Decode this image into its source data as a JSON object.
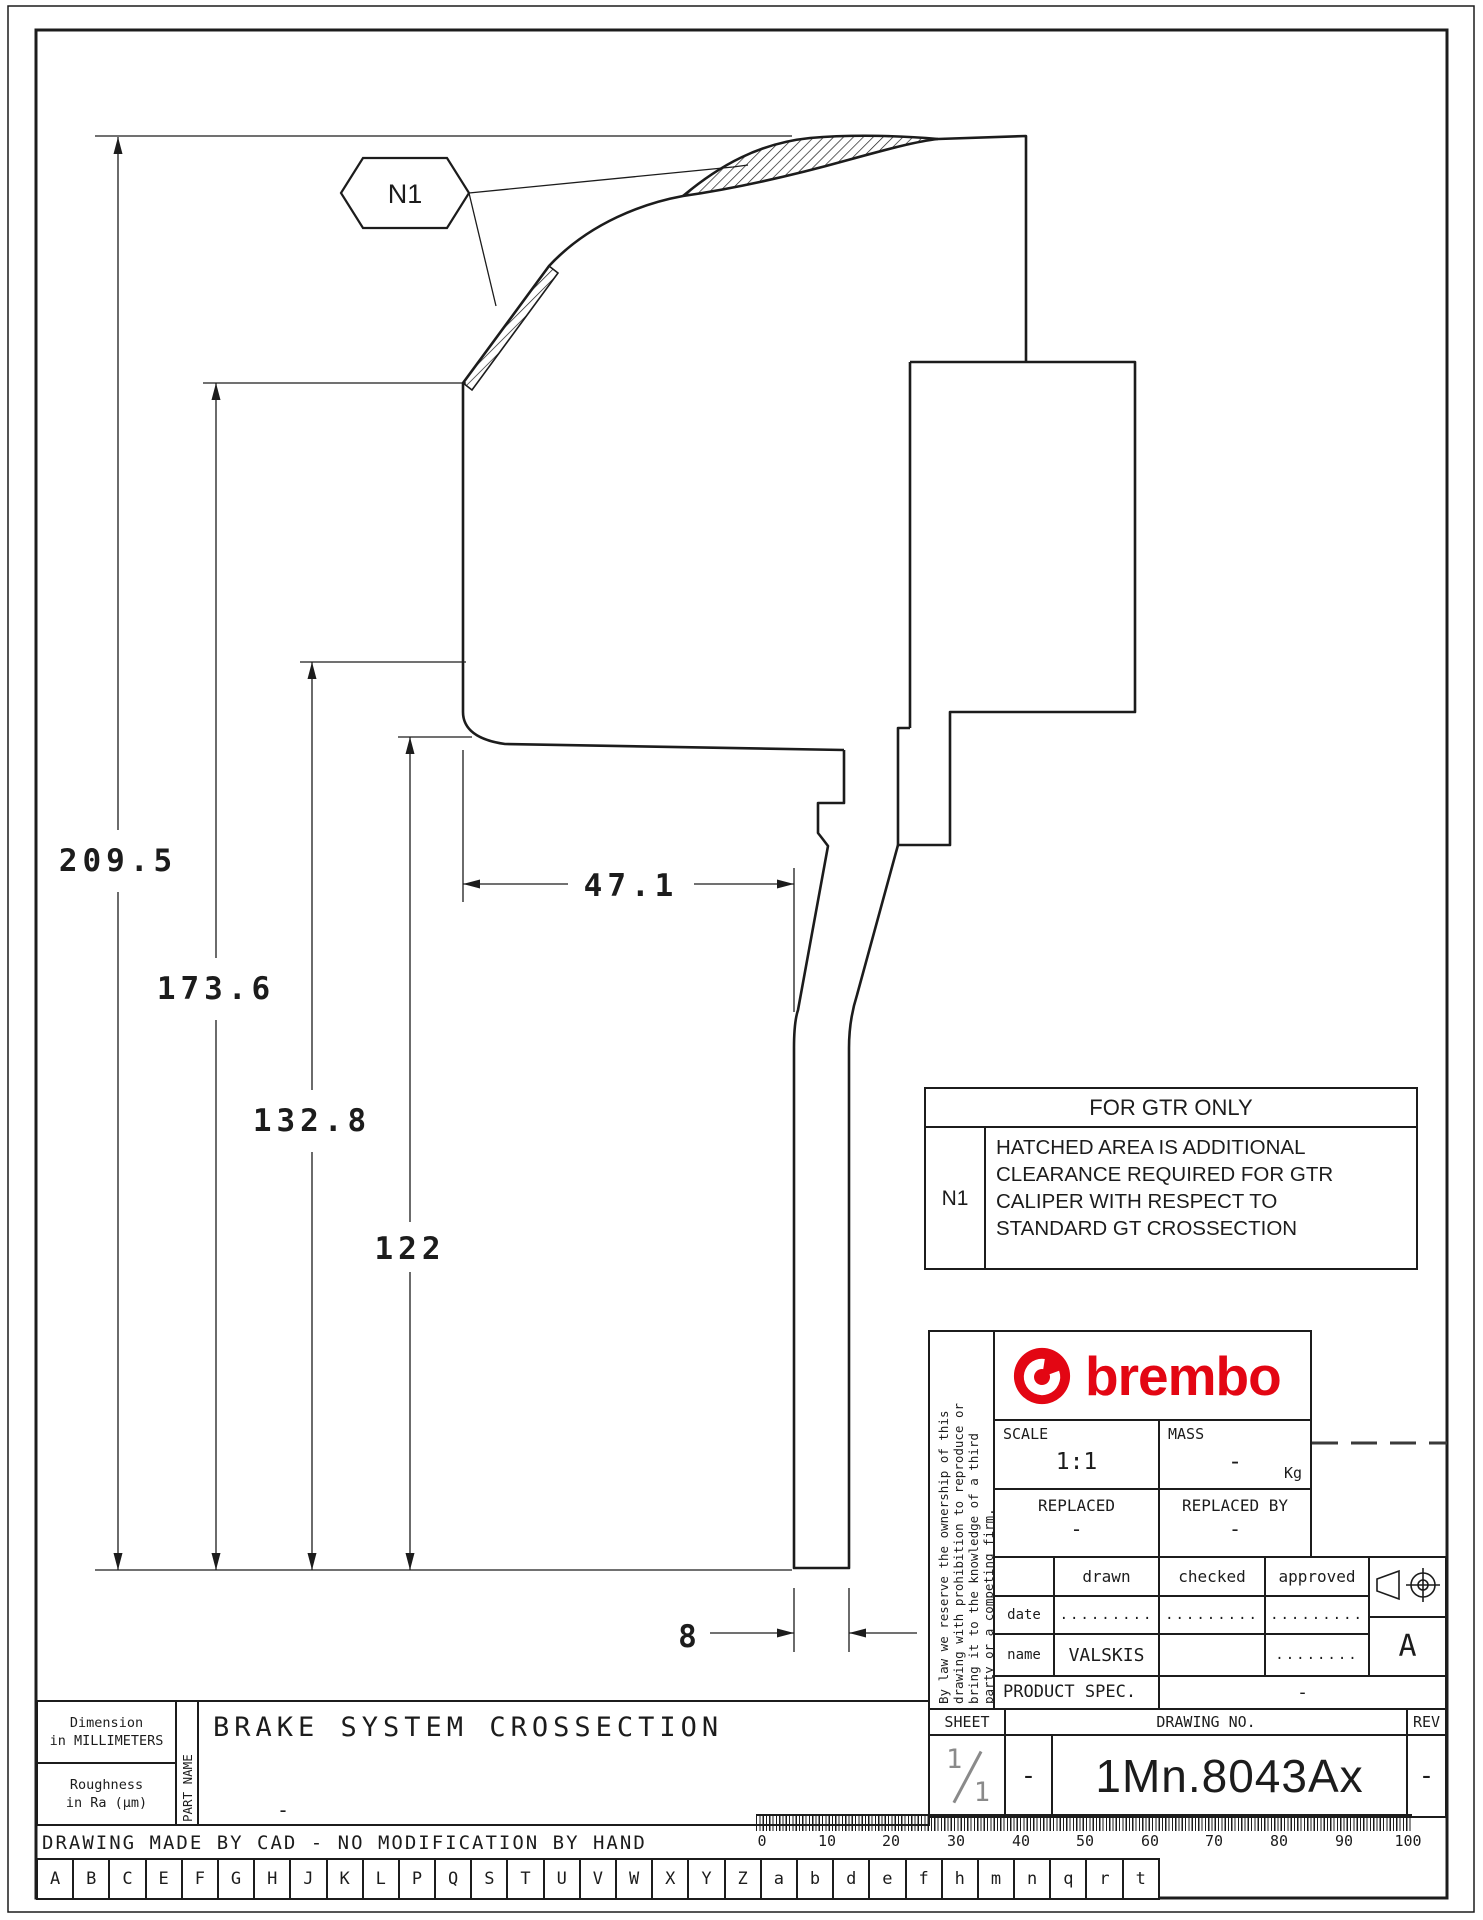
{
  "drawing": {
    "note_tag": "N1",
    "dimensions": {
      "overall_height": "209.5",
      "mid_height": "173.6",
      "inner_height": "132.8",
      "disc_height": "122",
      "offset_width": "47.1",
      "disc_thickness": "8"
    },
    "gtr_table": {
      "title": "FOR GTR ONLY",
      "note_id": "N1",
      "note_lines": [
        "HATCHED AREA IS ADDITIONAL",
        "CLEARANCE REQUIRED FOR GTR",
        "CALIPER WITH RESPECT TO",
        "STANDARD GT CROSSECTION"
      ]
    }
  },
  "title_block": {
    "disclaimer_lines": [
      "By law we reserve the ownership of this",
      "drawing with prohibition to reproduce or",
      "bring it to the knowledge of a third",
      "party or a competing firm."
    ],
    "brand_wordmark": "brembo",
    "scale_label": "SCALE",
    "scale_value": "1:1",
    "mass_label": "MASS",
    "mass_value": "-",
    "mass_unit": "Kg",
    "replaced_label": "REPLACED",
    "replaced_value": "-",
    "replaced_by_label": "REPLACED BY",
    "replaced_by_value": "-",
    "approvals": {
      "col_drawn": "drawn",
      "col_checked": "checked",
      "col_approved": "approved",
      "date_label": "date",
      "date_drawn": ".........",
      "date_checked": ".........",
      "date_approved": ".........",
      "name_label": "name",
      "name_drawn": "VALSKIS",
      "name_checked": "",
      "name_approved": "........"
    },
    "product_spec_label": "PRODUCT SPEC.",
    "product_spec_value": "-",
    "projection_letter": "A",
    "sheet_label": "SHEET",
    "sheet_num": "1",
    "sheet_den": "1",
    "sheet_dash": "-",
    "drawing_no_label": "DRAWING NO.",
    "drawing_no": "1Mn.8043Ax",
    "rev_label": "REV",
    "rev_value": "-"
  },
  "footer": {
    "dimension_note_1": "Dimension",
    "dimension_note_2": "in MILLIMETERS",
    "roughness_note_1": "Roughness",
    "roughness_note_2": "in Ra (μm)",
    "part_name_label": "PART NAME",
    "part_name": "BRAKE SYSTEM CROSSECTION",
    "part_name_sub": "-",
    "cad_note": "DRAWING MADE BY CAD - NO MODIFICATION BY HAND",
    "ruler": [
      "0",
      "10",
      "20",
      "30",
      "40",
      "50",
      "60",
      "70",
      "80",
      "90",
      "100"
    ],
    "letters": [
      "A",
      "B",
      "C",
      "E",
      "F",
      "G",
      "H",
      "J",
      "K",
      "L",
      "P",
      "Q",
      "S",
      "T",
      "U",
      "V",
      "W",
      "X",
      "Y",
      "Z",
      "a",
      "b",
      "d",
      "e",
      "f",
      "h",
      "m",
      "n",
      "q",
      "r",
      "t"
    ]
  },
  "colors": {
    "brand_red": "#e30613",
    "line": "#1c1c1c"
  }
}
